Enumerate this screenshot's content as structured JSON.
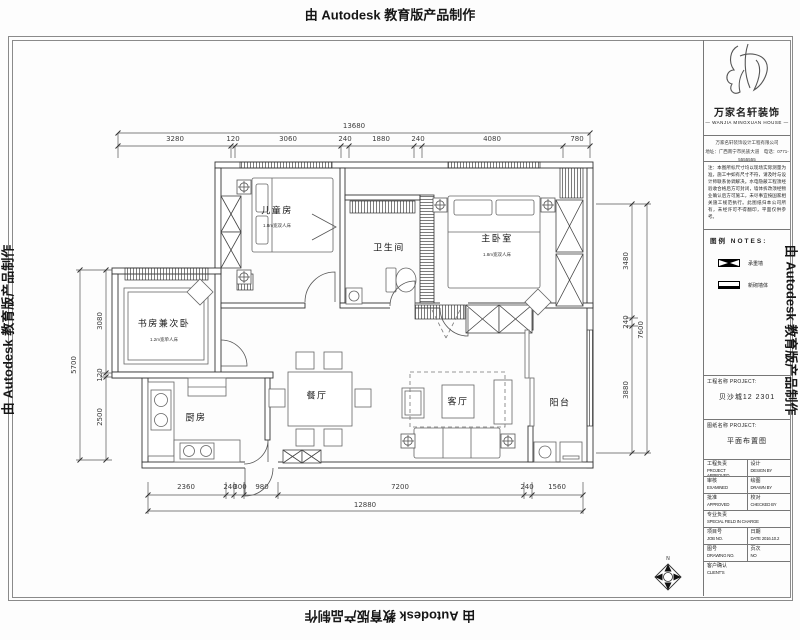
{
  "watermark": {
    "text": "由 Autodesk 教育版产品制作"
  },
  "title_block": {
    "company_name": "万家名轩装饰",
    "company_en": "— WANJIA MINGXUAN HOUSE —",
    "address_line1": "万家名轩装饰设计工程有限公司",
    "address_line2": "地址：广西南宁市民族大道　电话：0771-5555555",
    "notes_text": "注：本图所标尺寸均以现场实际测量为准，施工中如有尺寸不符，请及时与设计师联系协调解决。水电隐蔽工程须经验收合格后方可封闭，墙体拆改须经物业确认后方可施工，未尽事宜按国家相关施工规范执行。此图纸归本公司所有，未经许可不得翻印，平面仅供参考。",
    "legend_title": "图例  NOTES:",
    "legend": [
      {
        "label": "承重墙"
      },
      {
        "label": "新砌墙体"
      }
    ],
    "project_label": "工程名称 PROJECT:",
    "project_value": "贝沙城12 2301",
    "sheet_label": "图纸名称 PROJECT:",
    "sheet_value": "平面布置图",
    "rows": {
      "r1l_cn": "工程负责",
      "r1l_en": "PROJECT APPROVED",
      "r1r_cn": "设计",
      "r1r_en": "DESIGN BY",
      "r2l_cn": "审核",
      "r2l_en": "EXAMINED",
      "r2r_cn": "绘图",
      "r2r_en": "DRAWN BY",
      "r3l_cn": "批准",
      "r3l_en": "APPROVED",
      "r3r_cn": "校对",
      "r3r_en": "CHECKED BY",
      "r4_cn": "专业负责",
      "r4_en": "SPECIAL FIELD IN CHARGE",
      "r5l_cn": "项目号",
      "r5l_en": "JOB NO.",
      "r5r_cn": "日期",
      "r5r_en": "DATE 2016.10.2",
      "r6l_cn": "图号",
      "r6l_en": "DRAWING NO.",
      "r6r_cn": "页次",
      "r6r_en": "NO",
      "r7_cn": "客户确认",
      "r7_en": "CLIENT'S"
    }
  },
  "plan": {
    "rooms": [
      {
        "name": "儿童房",
        "sub": "1.8m宽双人床"
      },
      {
        "name": "卫生间",
        "sub": ""
      },
      {
        "name": "主卧室",
        "sub": "1.8m宽双人床"
      },
      {
        "name": "书房兼次卧",
        "sub": "1.2m宽单人床"
      },
      {
        "name": "厨房",
        "sub": ""
      },
      {
        "name": "餐厅",
        "sub": ""
      },
      {
        "name": "客厅",
        "sub": ""
      },
      {
        "name": "阳台",
        "sub": ""
      }
    ],
    "dims": {
      "top_total": "13680",
      "top": [
        "3280",
        "120",
        "3060",
        "240",
        "1880",
        "240",
        "4080",
        "780"
      ],
      "bottom": [
        "2360",
        "240",
        "300",
        "980",
        "7200",
        "240",
        "1560"
      ],
      "bottom_total": "12880",
      "left": [
        "3080",
        "120",
        "2500"
      ],
      "left_total": "5700",
      "right": [
        "3480",
        "240",
        "3880"
      ],
      "right_total": "7600"
    },
    "compass_n": "N"
  }
}
